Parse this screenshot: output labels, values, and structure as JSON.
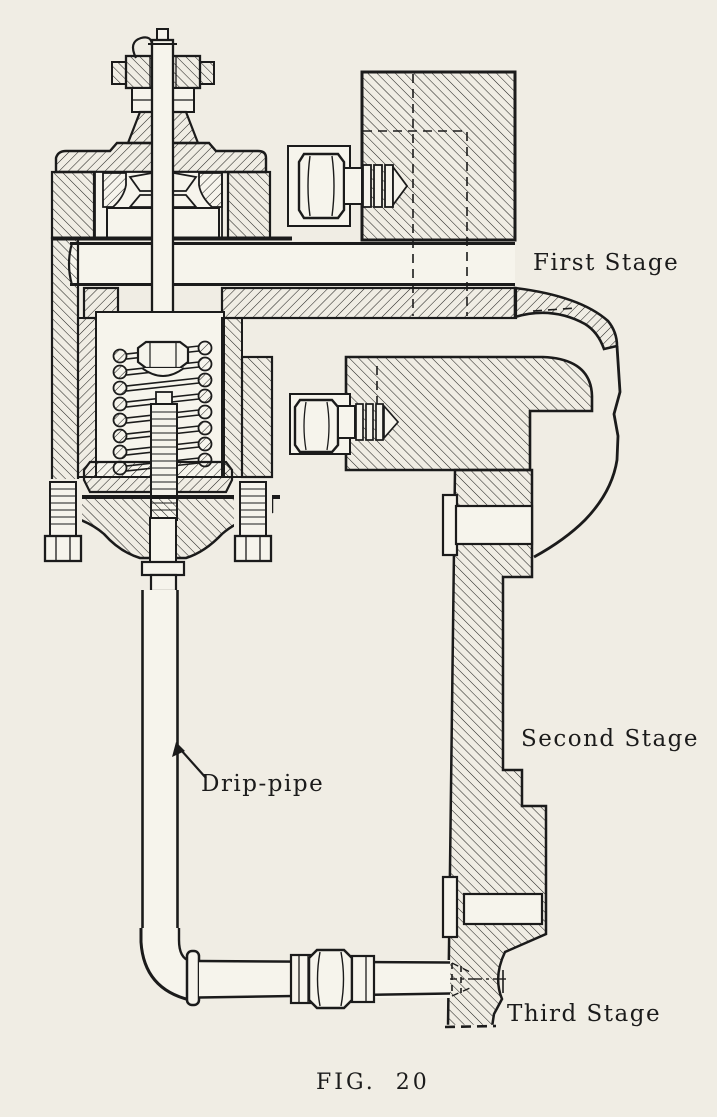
{
  "figure": {
    "caption": "FIG.  20",
    "drawing_type": "sectional engineering drawing of a three-stage drain (trap) valve",
    "labels": {
      "first_stage": "First Stage",
      "second_stage": "Second Stage",
      "third_stage": "Third Stage",
      "drip_pipe": "Drip-pipe"
    },
    "colors": {
      "paper": "#f0ede4",
      "ink": "#1b1b1b",
      "part_fill": "#f6f4ec"
    }
  }
}
